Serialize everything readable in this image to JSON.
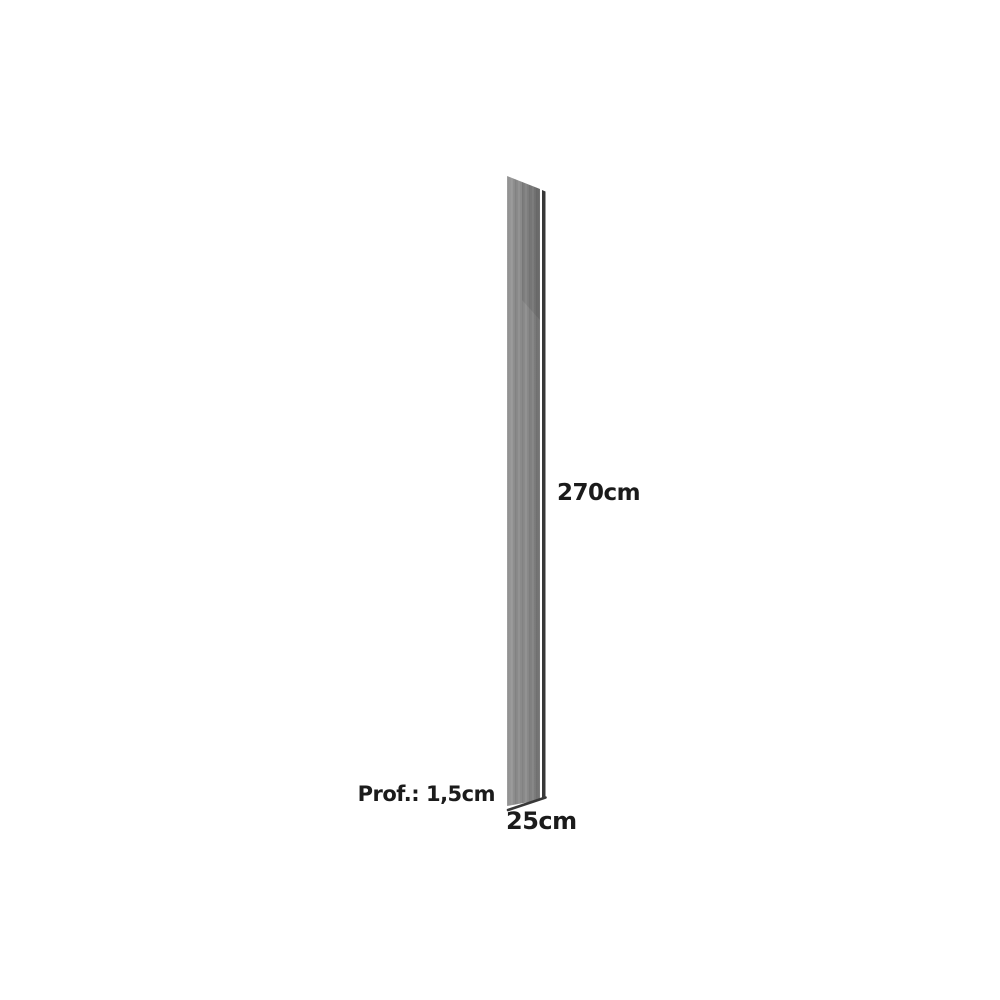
{
  "page": {
    "type": "product-dimension-diagram",
    "subject": "tall narrow panel shown in slight perspective"
  },
  "labels": {
    "height": "270cm",
    "depth": "Prof.: 1,5cm",
    "width": "25cm"
  },
  "colors": {
    "background": "#ffffff",
    "panel-light": "#9e9e9e",
    "panel-mid": "#8a8a8a",
    "panel-dark": "#717171",
    "panel-edge": "#383838",
    "label-text": "#1b1b1b"
  }
}
